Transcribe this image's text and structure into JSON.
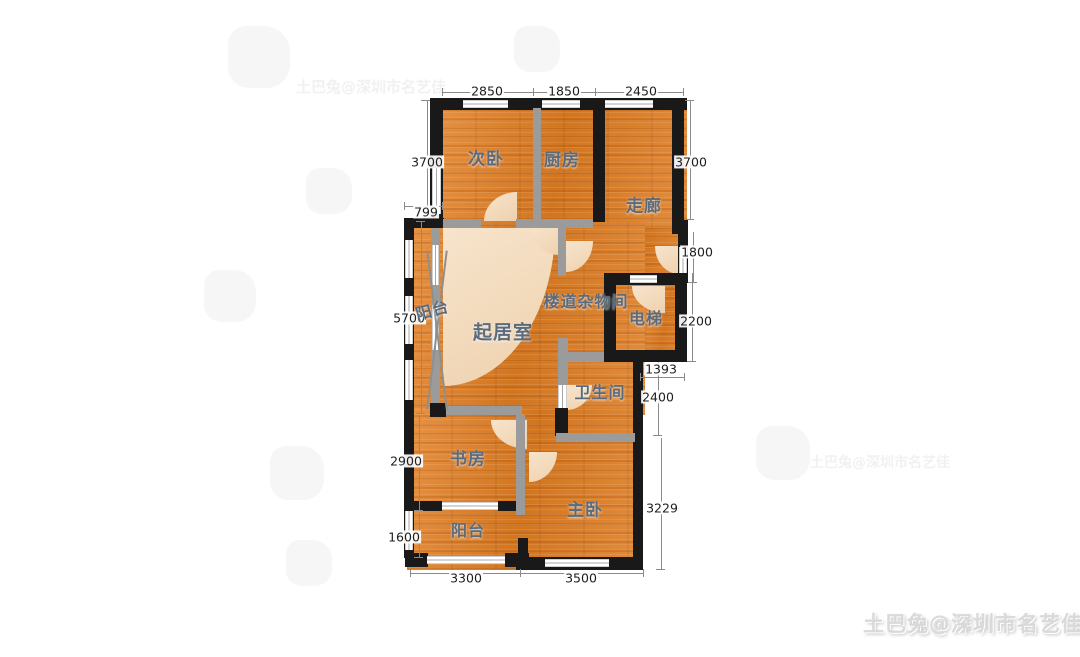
{
  "page": {
    "background": "#ffffff"
  },
  "floor_plan": {
    "rooms": {
      "secondary_bedroom": "次卧",
      "kitchen": "厨房",
      "corridor": "走廊",
      "side_balcony": "阳台",
      "living_room": "起居室",
      "stair_storage": "楼道杂物间",
      "elevator": "电梯",
      "bathroom": "卫生间",
      "study": "书房",
      "bottom_balcony": "阳台",
      "master_bedroom": "主卧"
    },
    "dimensions": {
      "top": [
        "2850",
        "1850",
        "2450"
      ],
      "left": [
        "3700",
        "799",
        "5700",
        "2900",
        "1600"
      ],
      "right": [
        "3700",
        "1800",
        "2200",
        "1393",
        "2400",
        "3229"
      ],
      "bottom": [
        "3300",
        "3500"
      ]
    },
    "colors": {
      "floor_wood": "#d9812f",
      "wall_exterior": "#1a1a1a",
      "wall_interior": "#9b9b9b",
      "door_arc": "#f4dcc2",
      "room_label": "#5a6b7d"
    }
  },
  "watermarks": {
    "credit": "土巴兔@深圳市名艺佳",
    "faint_text": "土巴兔@深圳市名艺佳"
  }
}
